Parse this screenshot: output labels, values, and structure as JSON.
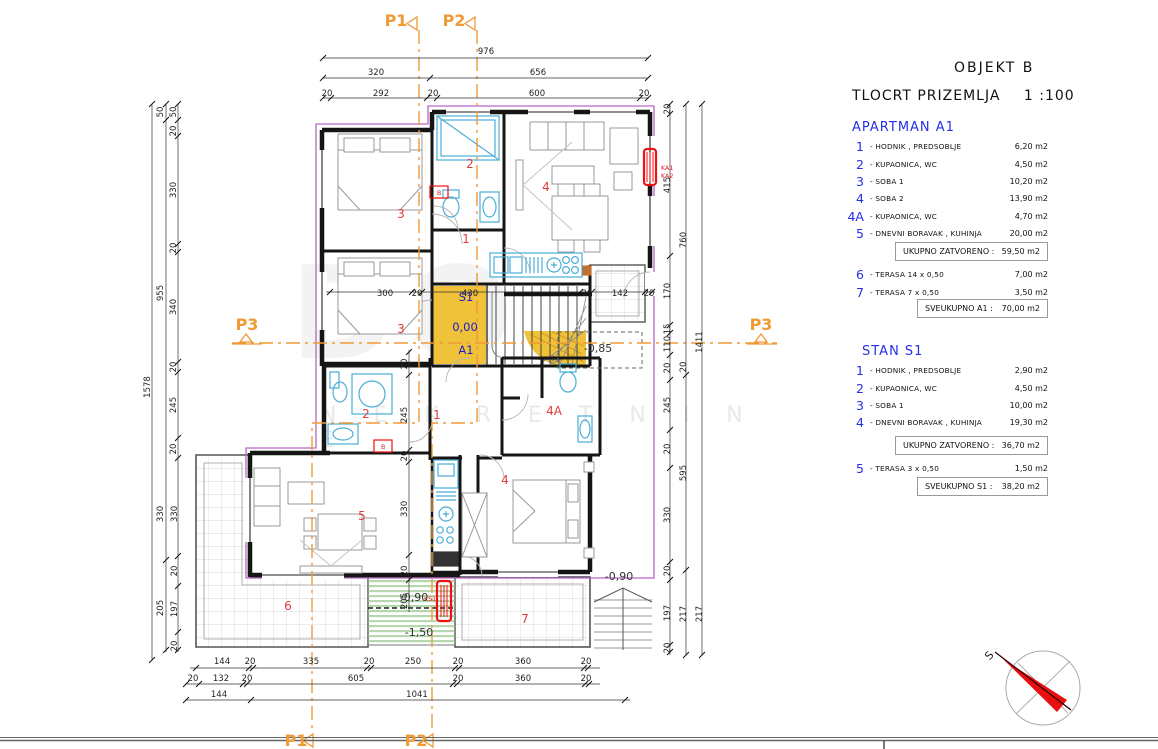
{
  "title_block": {
    "object_title": "OBJEKT  B",
    "drawing_title": "TLOCRT  PRIZEMLJA",
    "scale": "1 :100"
  },
  "legend": {
    "apartman_a1": {
      "header": "APARTMAN  A1",
      "rows": [
        {
          "n": "1",
          "label": "- HODNIK ,  PREDSOBLJE",
          "area": "6,20 m2"
        },
        {
          "n": "2",
          "label": "- KUPAONICA, WC",
          "area": "4,50 m2"
        },
        {
          "n": "3",
          "label": "- SOBA 1",
          "area": "10,20 m2"
        },
        {
          "n": "4",
          "label": "- SOBA 2",
          "area": "13,90 m2"
        },
        {
          "n": "4A",
          "label": "- KUPAONICA, WC",
          "area": "4,70 m2"
        },
        {
          "n": "5",
          "label": "- DNEVNI BORAVAK , KUHINJA",
          "area": "20,00 m2"
        }
      ],
      "subtotal_label": "UKUPNO ZATVORENO :",
      "subtotal_value": "59,50 m2",
      "terrace_rows": [
        {
          "n": "6",
          "label": "- TERASA  14 x 0,50",
          "area": "7,00 m2"
        },
        {
          "n": "7",
          "label": "- TERASA  7 x 0,50",
          "area": "3,50 m2"
        }
      ],
      "total_label": "SVEUKUPNO  A1 :",
      "total_value": "70,00 m2"
    },
    "stan_s1": {
      "header": "STAN  S1",
      "rows": [
        {
          "n": "1",
          "label": "- HODNIK ,  PREDSOBLJE",
          "area": "2,90 m2"
        },
        {
          "n": "2",
          "label": "- KUPAONICA, WC",
          "area": "4,50 m2"
        },
        {
          "n": "3",
          "label": "- SOBA 1",
          "area": "10,00 m2"
        },
        {
          "n": "4",
          "label": "- DNEVNI BORAVAK , KUHINJA",
          "area": "19,30 m2"
        }
      ],
      "subtotal_label": "UKUPNO ZATVORENO :",
      "subtotal_value": "36,70 m2",
      "terrace_rows": [
        {
          "n": "5",
          "label": "- TERASA  3 x 0,50",
          "area": "1,50 m2"
        }
      ],
      "total_label": "SVEUKUPNO  S1 :",
      "total_value": "38,20 m2"
    }
  },
  "plan": {
    "colors": {
      "section_orange": "#f09a36",
      "boundary_purple": "#b665c6",
      "room_red": "#e23c3c",
      "unit_blue": "#1c1ccf",
      "highlight_yellow": "#f0c23a",
      "radiator_red": "#ee1111",
      "sanitary_blue": "#4aaed6",
      "hatch_green": "#b7d8af"
    },
    "texts": [
      [
        "976",
        486,
        54,
        "dim"
      ],
      [
        "320",
        376,
        75,
        "dim"
      ],
      [
        "656",
        538,
        75,
        "dim"
      ],
      [
        "20",
        327,
        96,
        "dim"
      ],
      [
        "292",
        381,
        96,
        "dim"
      ],
      [
        "20",
        433,
        96,
        "dim"
      ],
      [
        "600",
        537,
        96,
        "dim"
      ],
      [
        "20",
        644,
        96,
        "dim"
      ],
      [
        "144",
        222,
        664,
        "dim"
      ],
      [
        "20",
        250,
        664,
        "dim"
      ],
      [
        "335",
        311,
        664,
        "dim"
      ],
      [
        "20",
        369,
        664,
        "dim"
      ],
      [
        "250",
        413,
        664,
        "dim"
      ],
      [
        "20",
        458,
        664,
        "dim"
      ],
      [
        "360",
        523,
        664,
        "dim"
      ],
      [
        "20",
        586,
        664,
        "dim"
      ],
      [
        "20",
        193,
        681,
        "dim"
      ],
      [
        "132",
        221,
        681,
        "dim"
      ],
      [
        "20",
        247,
        681,
        "dim"
      ],
      [
        "605",
        356,
        681,
        "dim"
      ],
      [
        "20",
        458,
        681,
        "dim"
      ],
      [
        "360",
        523,
        681,
        "dim"
      ],
      [
        "20",
        586,
        681,
        "dim"
      ],
      [
        "144",
        219,
        697,
        "dim"
      ],
      [
        "1041",
        417,
        697,
        "dim"
      ],
      [
        "1578",
        150,
        387,
        "dim",
        1
      ],
      [
        "50",
        163,
        112,
        "dim",
        1
      ],
      [
        "955",
        163,
        293,
        "dim",
        1
      ],
      [
        "330",
        163,
        514,
        "dim",
        1
      ],
      [
        "205",
        163,
        608,
        "dim",
        1
      ],
      [
        "50",
        176,
        112,
        "dim",
        1
      ],
      [
        "20",
        176,
        131,
        "dim",
        1
      ],
      [
        "330",
        176,
        190,
        "dim",
        1
      ],
      [
        "20",
        176,
        248,
        "dim",
        1
      ],
      [
        "340",
        176,
        307,
        "dim",
        1
      ],
      [
        "20",
        176,
        367,
        "dim",
        1
      ],
      [
        "245",
        176,
        405,
        "dim",
        1
      ],
      [
        "20",
        176,
        449,
        "dim",
        1
      ],
      [
        "330",
        177,
        514,
        "dim",
        1
      ],
      [
        "20",
        177,
        571,
        "dim",
        1
      ],
      [
        "197",
        177,
        609,
        "dim",
        1
      ],
      [
        "20",
        177,
        646,
        "dim",
        1
      ],
      [
        "20",
        670,
        109,
        "dim",
        1
      ],
      [
        "415",
        670,
        185,
        "dim",
        1
      ],
      [
        "170",
        670,
        291,
        "dim",
        1
      ],
      [
        "15",
        670,
        329,
        "dim",
        1
      ],
      [
        "110",
        670,
        344,
        "dim",
        1
      ],
      [
        "20",
        670,
        368,
        "dim",
        1
      ],
      [
        "245",
        670,
        405,
        "dim",
        1
      ],
      [
        "20",
        670,
        449,
        "dim",
        1
      ],
      [
        "330",
        670,
        515,
        "dim",
        1
      ],
      [
        "20",
        670,
        571,
        "dim",
        1
      ],
      [
        "197",
        670,
        613,
        "dim",
        1
      ],
      [
        "20",
        670,
        648,
        "dim",
        1
      ],
      [
        "760",
        686,
        240,
        "dim",
        1
      ],
      [
        "20",
        686,
        367,
        "dim",
        1
      ],
      [
        "595",
        686,
        473,
        "dim",
        1
      ],
      [
        "217",
        686,
        614,
        "dim",
        1
      ],
      [
        "1411",
        702,
        342,
        "dim",
        1
      ],
      [
        "217",
        702,
        614,
        "dim",
        1
      ],
      [
        "300",
        385,
        296,
        "dim"
      ],
      [
        "20",
        417,
        296,
        "dim"
      ],
      [
        "430",
        470,
        296,
        "dim"
      ],
      [
        "20",
        587,
        296,
        "dim"
      ],
      [
        "142",
        620,
        296,
        "dim"
      ],
      [
        "20",
        649,
        296,
        "dim"
      ],
      [
        "20",
        407,
        364,
        "dim",
        1
      ],
      [
        "245",
        407,
        415,
        "dim",
        1
      ],
      [
        "20",
        407,
        456,
        "dim",
        1
      ],
      [
        "330",
        407,
        509,
        "dim",
        1
      ],
      [
        "20",
        407,
        571,
        "dim",
        1
      ],
      [
        "205",
        407,
        601,
        "dim",
        1
      ],
      [
        "2",
        470,
        168,
        "room"
      ],
      [
        "4",
        546,
        191,
        "room"
      ],
      [
        "3",
        401,
        218,
        "room"
      ],
      [
        "1",
        466,
        243,
        "room"
      ],
      [
        "3",
        401,
        333,
        "room"
      ],
      [
        "2",
        366,
        418,
        "room"
      ],
      [
        "1",
        437,
        419,
        "room"
      ],
      [
        "4A",
        554,
        415,
        "room"
      ],
      [
        "4",
        505,
        484,
        "room"
      ],
      [
        "5",
        362,
        520,
        "room"
      ],
      [
        "6",
        288,
        610,
        "room"
      ],
      [
        "7",
        525,
        623,
        "room"
      ],
      [
        "S1",
        466,
        301,
        "unit"
      ],
      [
        "0,00",
        465,
        331,
        "unit"
      ],
      [
        "A1",
        466,
        354,
        "unit"
      ],
      [
        "-0,85",
        598,
        352,
        "level"
      ],
      [
        "-0,90",
        619,
        580,
        "level"
      ],
      [
        "-0,90",
        414,
        601,
        "level"
      ],
      [
        "-1,50",
        419,
        636,
        "level"
      ],
      [
        "KA1",
        661,
        170,
        "equip"
      ],
      [
        "KA2",
        661,
        178,
        "equip"
      ],
      [
        "KS1",
        424,
        601,
        "equip"
      ],
      [
        "B",
        437,
        195,
        "equip"
      ],
      [
        "B",
        381,
        449,
        "equip"
      ],
      [
        "P1",
        396,
        26,
        "section"
      ],
      [
        "P2",
        454,
        26,
        "section"
      ],
      [
        "P3",
        247,
        330,
        "section"
      ],
      [
        "P3",
        761,
        330,
        "section"
      ],
      [
        "P1",
        296,
        746,
        "section"
      ],
      [
        "P2",
        416,
        746,
        "section"
      ]
    ]
  },
  "compass": {
    "label": "S"
  }
}
